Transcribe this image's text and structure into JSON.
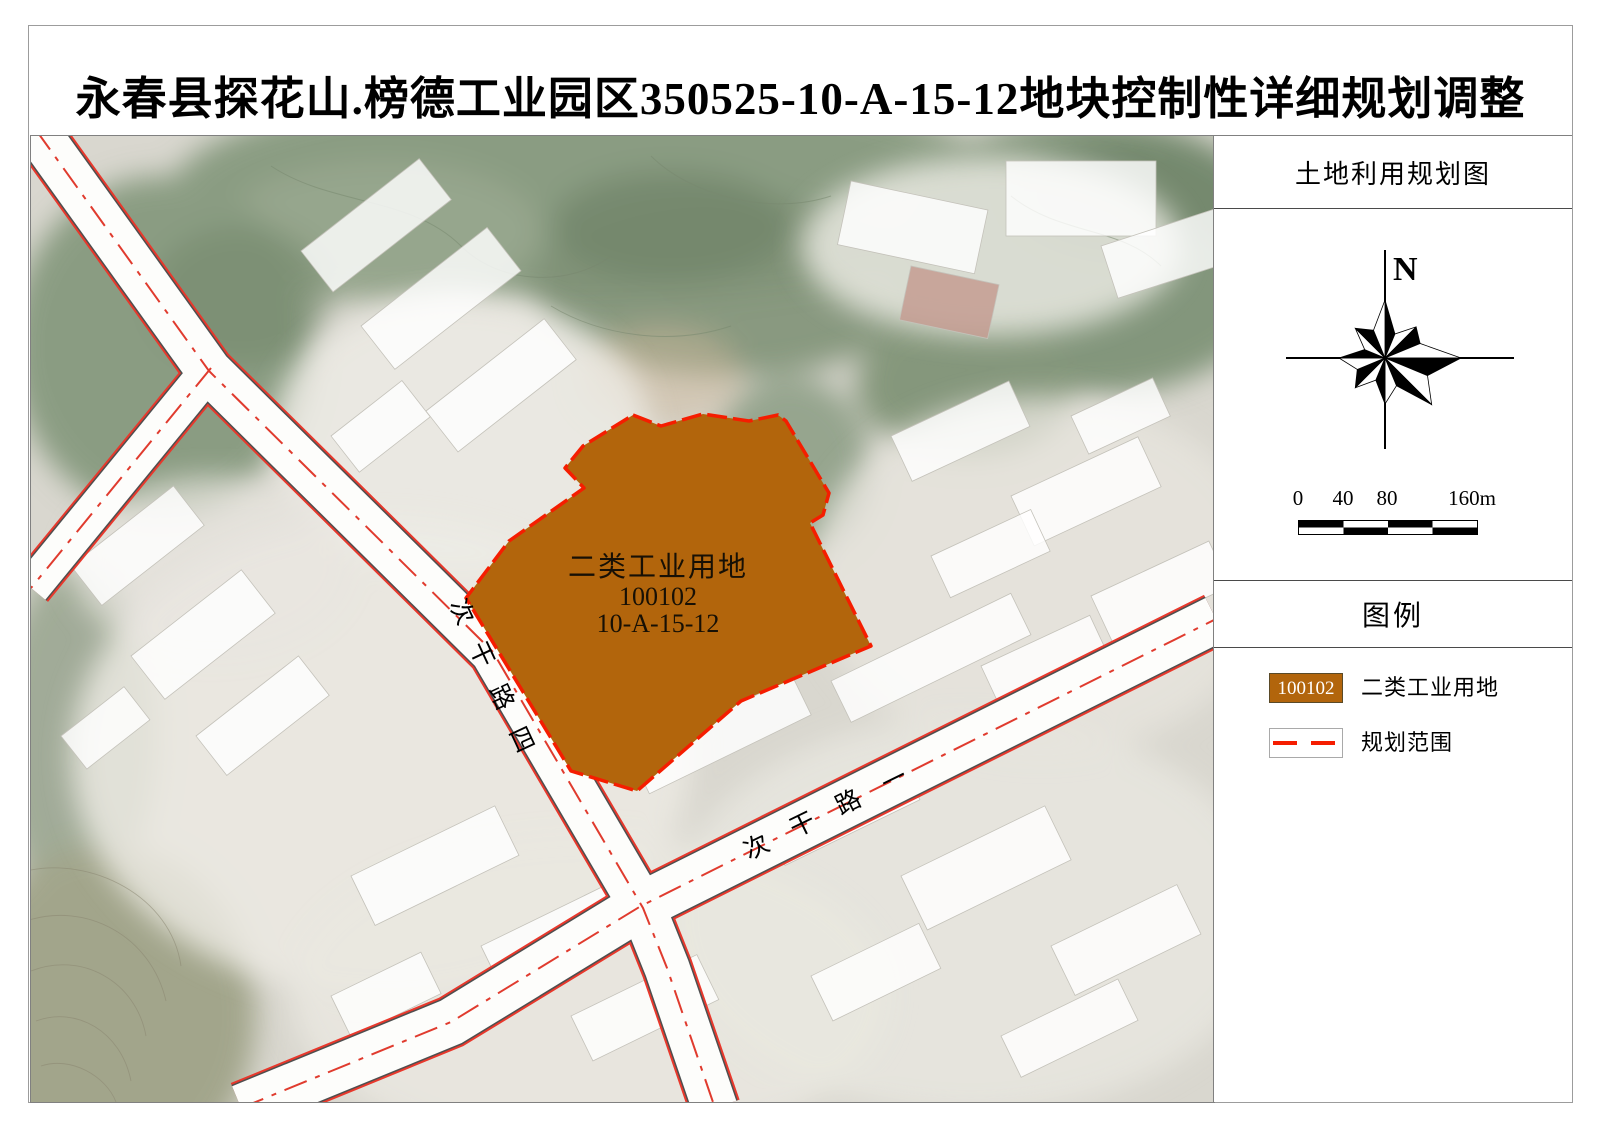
{
  "title": "永春县探花山.榜德工业园区350525-10-A-15-12地块控制性详细规划调整",
  "sidebar": {
    "map_title": "土地利用规划图",
    "compass_north": "N",
    "scalebar": {
      "labels": [
        "0",
        "40",
        "80",
        "160m"
      ]
    },
    "legend": {
      "title": "图例",
      "items": [
        {
          "code": "100102",
          "label": "二类工业用地"
        },
        {
          "label": "规划范围"
        }
      ]
    }
  },
  "map": {
    "parcel": {
      "name": "二类工业用地",
      "code": "100102",
      "plot_no": "10-A-15-12"
    },
    "roads": [
      {
        "name": "次干路四"
      },
      {
        "name": "次干路一"
      }
    ]
  },
  "colors": {
    "parcel_fill": "#b2650c",
    "boundary_red": "#f51d00",
    "road_centerline": "#e03b2e"
  }
}
